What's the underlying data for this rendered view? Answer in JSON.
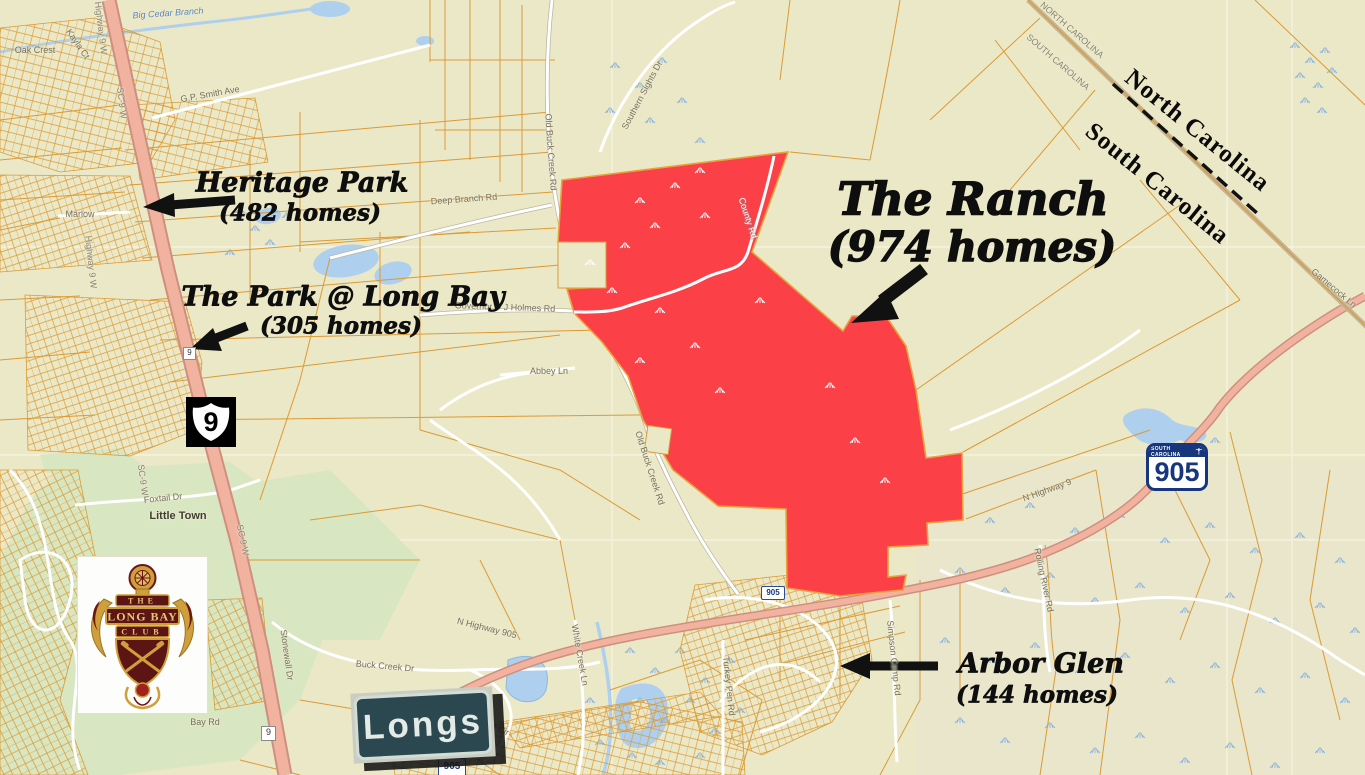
{
  "annotations": {
    "heritage_park": {
      "name": "Heritage Park",
      "homes": "(482 homes)"
    },
    "park_at_long_bay": {
      "name": "The Park @ Long Bay",
      "homes": "(305 homes)"
    },
    "the_ranch": {
      "name": "The Ranch",
      "homes": "(974 homes)"
    },
    "arbor_glen": {
      "name": "Arbor Glen",
      "homes": "(144 homes)"
    }
  },
  "state_line": {
    "north": "North Carolina",
    "south": "South Carolina"
  },
  "signs": {
    "longs": "Longs",
    "us9": "9",
    "sc905_state": "SOUTH CAROLINA",
    "sc905_number": "905",
    "marker_905": "905",
    "marker_9": "9"
  },
  "logo": {
    "the": "THE",
    "long_bay": "LONG BAY",
    "club": "CLUB"
  },
  "colors": {
    "ranch_red": "#fb4048",
    "parcel_orange": "#dc9a33",
    "highway_salmon": "#f1b3a0",
    "water_blue": "#aecfee",
    "golf_green": "#d9e6c2"
  },
  "map_labels": [
    {
      "text": "Big Cedar Branch",
      "x": 168,
      "y": 13,
      "rot": -4,
      "cls": "wt"
    },
    {
      "text": "Oak Crest",
      "x": 35,
      "y": 50,
      "rot": 0,
      "cls": "st"
    },
    {
      "text": "Kayla Ct",
      "x": 78,
      "y": 44,
      "rot": 55,
      "cls": "st"
    },
    {
      "text": "Highway 9 W",
      "x": 101,
      "y": 28,
      "rot": 83,
      "cls": "hw"
    },
    {
      "text": "SC-9 W",
      "x": 122,
      "y": 103,
      "rot": 83,
      "cls": "hw"
    },
    {
      "text": "G.P. Smith Ave",
      "x": 210,
      "y": 94,
      "rot": -10,
      "cls": "st"
    },
    {
      "text": "Marlow",
      "x": 80,
      "y": 214,
      "rot": 0,
      "cls": "st"
    },
    {
      "text": "Highway 9 W",
      "x": 91,
      "y": 262,
      "rot": 84,
      "cls": "hw"
    },
    {
      "text": "Deep Branch Rd",
      "x": 464,
      "y": 199,
      "rot": -4,
      "cls": "st"
    },
    {
      "text": "Old Buck Creek Rd",
      "x": 551,
      "y": 152,
      "rot": 86,
      "cls": "st"
    },
    {
      "text": "Southern Sights Dr",
      "x": 642,
      "y": 95,
      "rot": -62,
      "cls": "st"
    },
    {
      "text": "SC-9 W",
      "x": 143,
      "y": 480,
      "rot": 82,
      "cls": "hw"
    },
    {
      "text": "Governor D J Holmes Rd",
      "x": 505,
      "y": 307,
      "rot": 2,
      "cls": "st"
    },
    {
      "text": "Abbey Ln",
      "x": 549,
      "y": 371,
      "rot": 0,
      "cls": "st"
    },
    {
      "text": "County Rd",
      "x": 748,
      "y": 218,
      "rot": 72,
      "cls": "lt"
    },
    {
      "text": "Old Buck Creek Rd",
      "x": 650,
      "y": 468,
      "rot": 72,
      "cls": "st"
    },
    {
      "text": "Foxtail Dr",
      "x": 163,
      "y": 498,
      "rot": -6,
      "cls": "st"
    },
    {
      "text": "Little Town",
      "x": 178,
      "y": 516,
      "rot": 0,
      "cls": "pl"
    },
    {
      "text": "SC-9 W",
      "x": 243,
      "y": 540,
      "rot": 78,
      "cls": "hw"
    },
    {
      "text": "Buck Creek Dr",
      "x": 385,
      "y": 666,
      "rot": 5,
      "cls": "st"
    },
    {
      "text": "Stonewall Dr",
      "x": 287,
      "y": 655,
      "rot": 82,
      "cls": "st"
    },
    {
      "text": "Bay Rd",
      "x": 205,
      "y": 722,
      "rot": 0,
      "cls": "st"
    },
    {
      "text": "ton Cir",
      "x": 497,
      "y": 727,
      "rot": 28,
      "cls": "st"
    },
    {
      "text": "White Creek Ln",
      "x": 580,
      "y": 655,
      "rot": 80,
      "cls": "st"
    },
    {
      "text": "N Highway 905",
      "x": 487,
      "y": 628,
      "rot": 14,
      "cls": "st"
    },
    {
      "text": "N Highway 9",
      "x": 1047,
      "y": 490,
      "rot": -20,
      "cls": "st"
    },
    {
      "text": "Turkey Pen Rd",
      "x": 729,
      "y": 686,
      "rot": 84,
      "cls": "st"
    },
    {
      "text": "Simpson Camp Rd",
      "x": 894,
      "y": 658,
      "rot": 84,
      "cls": "st"
    },
    {
      "text": "Rolling River Rd",
      "x": 1044,
      "y": 580,
      "rot": 78,
      "cls": "st"
    },
    {
      "text": "Gamecock Ln",
      "x": 1334,
      "y": 288,
      "rot": 40,
      "cls": "st"
    },
    {
      "text": "NORTH CAROLINA",
      "x": 1072,
      "y": 30,
      "rot": 41,
      "cls": "hw"
    },
    {
      "text": "SOUTH CAROLINA",
      "x": 1058,
      "y": 62,
      "rot": 41,
      "cls": "hw"
    }
  ]
}
